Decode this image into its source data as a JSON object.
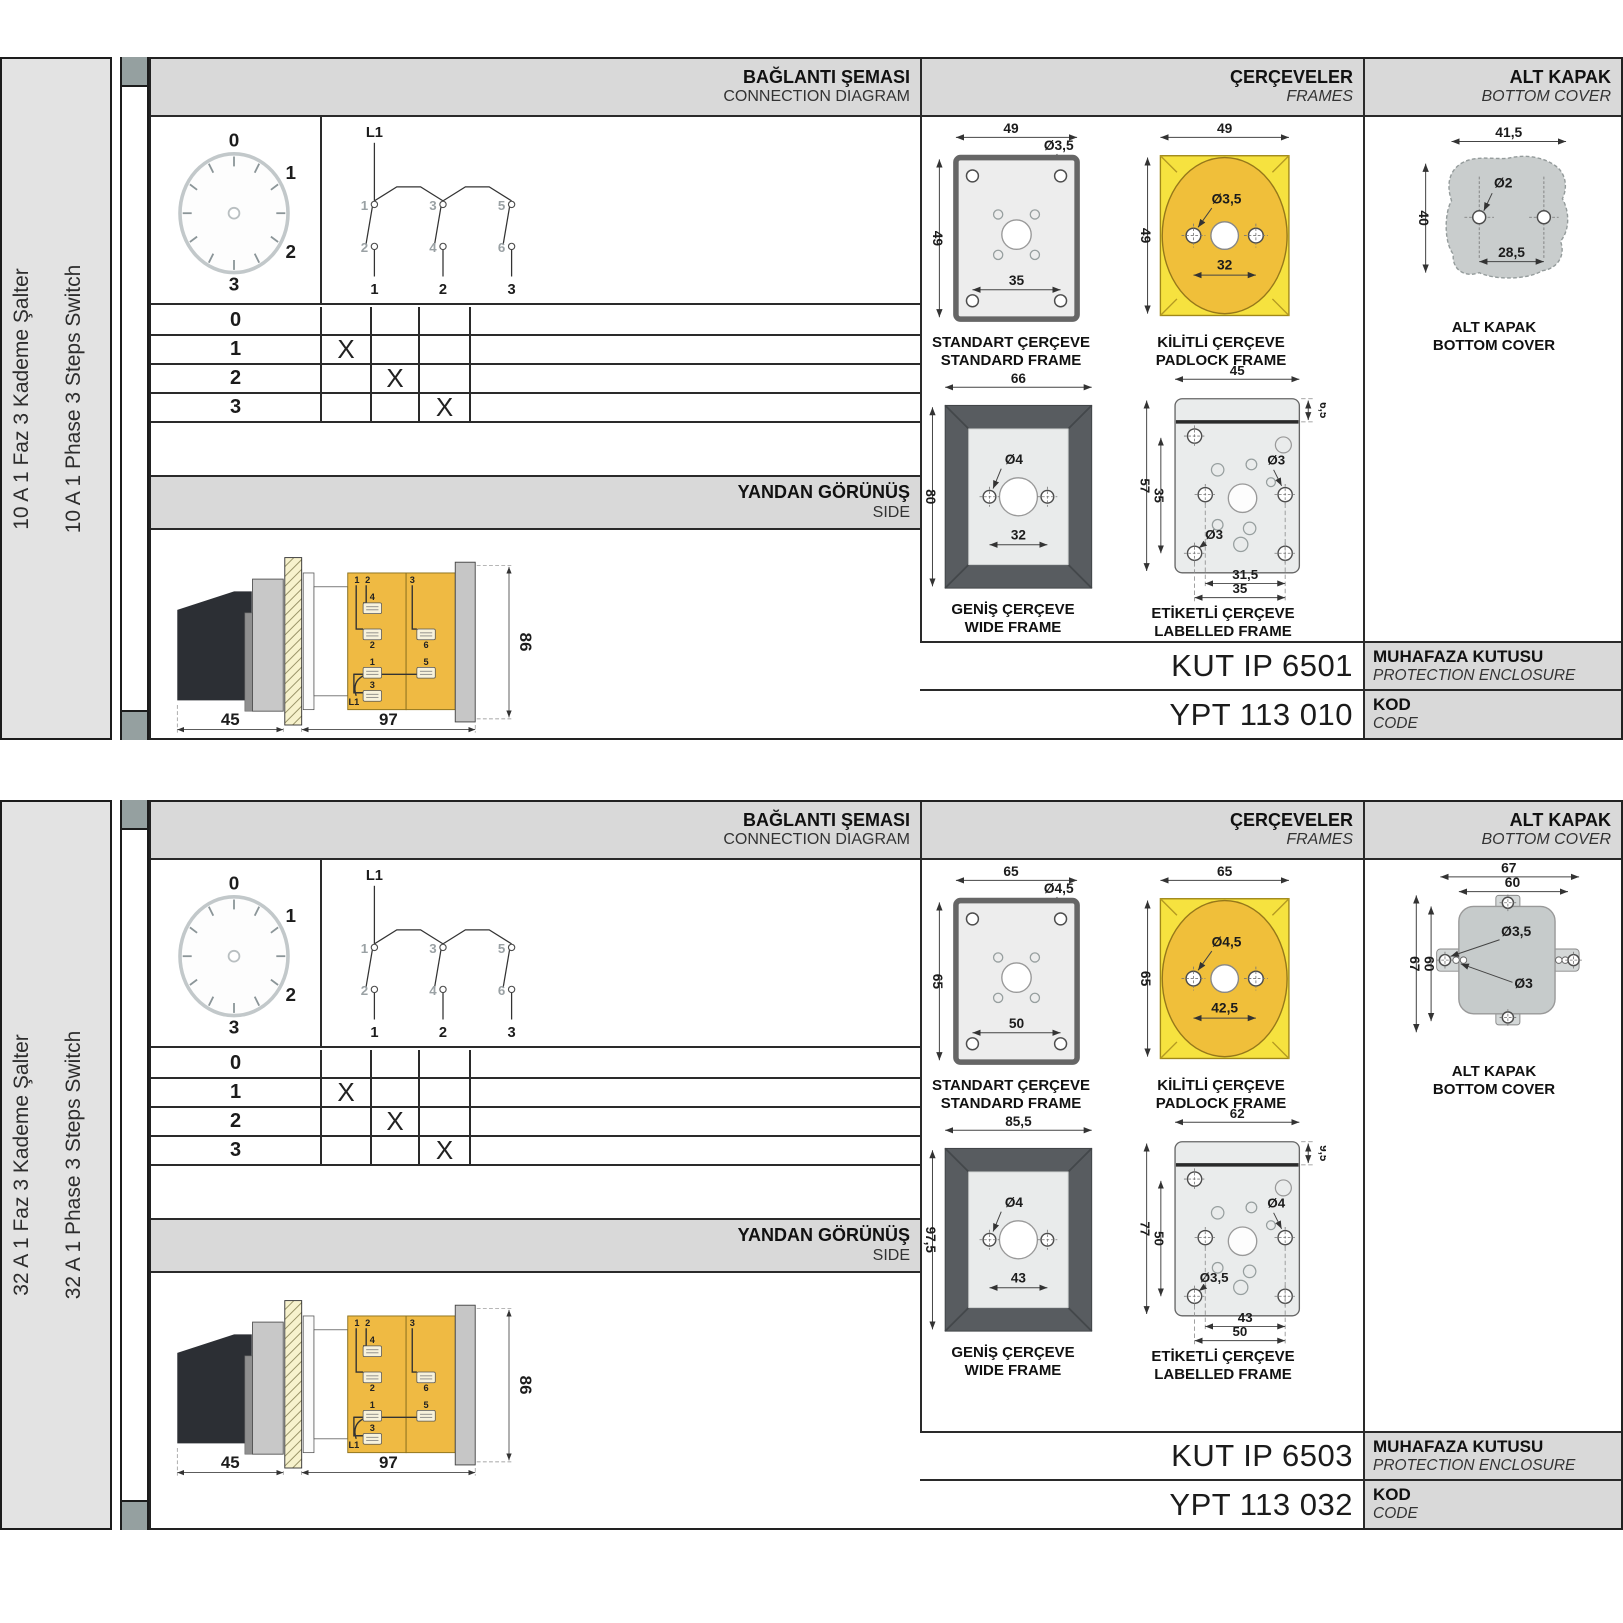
{
  "colors": {
    "header_grey": "#d9d9d9",
    "padlock_yellow": "#f6e23f",
    "padlock_gold": "#f0bf3a",
    "body_amber": "#efba43",
    "wide_frame_dark": "#585c60",
    "cover_grey": "#c9cdcd",
    "rail_grey": "#e3e3e3"
  },
  "sections": [
    {
      "sidebar": {
        "label_tr": "10 A 1 Faz 3 Kademe Şalter",
        "label_en": "10 A 1 Phase 3 Steps Switch"
      },
      "headers": {
        "connection_tr": "BAĞLANTI ŞEMASI",
        "connection_en": "CONNECTION DIAGRAM",
        "frames_tr": "ÇERÇEVELER",
        "frames_en": "FRAMES",
        "cover_tr": "ALT KAPAK",
        "cover_en": "BOTTOM COVER",
        "side_tr": "YANDAN GÖRÜNÜŞ",
        "side_en": "SIDE"
      },
      "dial": {
        "labels": [
          "0",
          "1",
          "2",
          "3"
        ]
      },
      "schematic": {
        "feed": "L1",
        "top_terms": [
          "1",
          "3",
          "5"
        ],
        "bottom_terms": [
          "2",
          "4",
          "6"
        ],
        "poles": [
          "1",
          "2",
          "3"
        ]
      },
      "step_table": {
        "rows": [
          {
            "step": "0",
            "marks": [
              "",
              "",
              ""
            ]
          },
          {
            "step": "1",
            "marks": [
              "X",
              "",
              ""
            ]
          },
          {
            "step": "2",
            "marks": [
              "",
              "X",
              ""
            ]
          },
          {
            "step": "3",
            "marks": [
              "",
              "",
              "X"
            ]
          }
        ]
      },
      "side_view": {
        "dim_width_handle": "45",
        "dim_width_body": "97",
        "dim_height": "86",
        "labels": {
          "top_left_a": "1",
          "top_left_b": "2",
          "top_right": "3",
          "t4": "4",
          "t2": "2",
          "t6": "6",
          "t1": "1",
          "t5": "5",
          "t3": "3",
          "feed": "L1"
        }
      },
      "standard_frame": {
        "title_tr": "STANDART ÇERÇEVE",
        "title_en": "STANDARD FRAME",
        "dim_width": "49",
        "dim_height": "49",
        "hole_dia": "Ø3,5",
        "dim_holes": "35"
      },
      "padlock_frame": {
        "title_tr": "KİLİTLİ ÇERÇEVE",
        "title_en": "PADLOCK FRAME",
        "dim_width": "49",
        "dim_height": "49",
        "hole_dia": "Ø3,5",
        "dim_holes": "32"
      },
      "wide_frame": {
        "title_tr": "GENİŞ ÇERÇEVE",
        "title_en": "WIDE FRAME",
        "dim_width": "66",
        "dim_height": "80",
        "hole_dia": "Ø4",
        "dim_holes": "32"
      },
      "labelled_frame": {
        "title_tr": "ETİKETLİ ÇERÇEVE",
        "title_en": "LABELLED FRAME",
        "dim_width": "45",
        "dim_strip": "6,5",
        "dim_height_outer": "57",
        "dim_height_inner": "35",
        "hole_dia_right": "Ø3",
        "hole_dia_left": "Ø3",
        "dim_holes_inner": "31,5",
        "dim_holes_outer": "35"
      },
      "bottom_cover": {
        "title_tr": "ALT KAPAK",
        "title_en": "BOTTOM COVER",
        "dim_width": "41,5",
        "dim_height": "40",
        "hole_dia": "Ø2",
        "dim_holes": "28,5"
      },
      "codes": {
        "enclosure_code": "KUT IP 6501",
        "enclosure_label_tr": "MUHAFAZA KUTUSU",
        "enclosure_label_en": "PROTECTION ENCLOSURE",
        "product_code": "YPT 113 010",
        "code_label_tr": "KOD",
        "code_label_en": "CODE"
      }
    },
    {
      "sidebar": {
        "label_tr": "32 A 1 Faz 3 Kademe Şalter",
        "label_en": "32 A 1 Phase 3 Steps Switch"
      },
      "headers": {
        "connection_tr": "BAĞLANTI ŞEMASI",
        "connection_en": "CONNECTION DIAGRAM",
        "frames_tr": "ÇERÇEVELER",
        "frames_en": "FRAMES",
        "cover_tr": "ALT KAPAK",
        "cover_en": "BOTTOM COVER",
        "side_tr": "YANDAN GÖRÜNÜŞ",
        "side_en": "SIDE"
      },
      "dial": {
        "labels": [
          "0",
          "1",
          "2",
          "3"
        ]
      },
      "schematic": {
        "feed": "L1",
        "top_terms": [
          "1",
          "3",
          "5"
        ],
        "bottom_terms": [
          "2",
          "4",
          "6"
        ],
        "poles": [
          "1",
          "2",
          "3"
        ]
      },
      "step_table": {
        "rows": [
          {
            "step": "0",
            "marks": [
              "",
              "",
              ""
            ]
          },
          {
            "step": "1",
            "marks": [
              "X",
              "",
              ""
            ]
          },
          {
            "step": "2",
            "marks": [
              "",
              "X",
              ""
            ]
          },
          {
            "step": "3",
            "marks": [
              "",
              "",
              "X"
            ]
          }
        ]
      },
      "side_view": {
        "dim_width_handle": "45",
        "dim_width_body": "97",
        "dim_height": "86",
        "labels": {
          "top_left_a": "1",
          "top_left_b": "2",
          "top_right": "3",
          "t4": "4",
          "t2": "2",
          "t6": "6",
          "t1": "1",
          "t5": "5",
          "t3": "3",
          "feed": "L1"
        }
      },
      "standard_frame": {
        "title_tr": "STANDART ÇERÇEVE",
        "title_en": "STANDARD FRAME",
        "dim_width": "65",
        "dim_height": "65",
        "hole_dia": "Ø4,5",
        "dim_holes": "50"
      },
      "padlock_frame": {
        "title_tr": "KİLİTLİ ÇERÇEVE",
        "title_en": "PADLOCK FRAME",
        "dim_width": "65",
        "dim_height": "65",
        "hole_dia": "Ø4,5",
        "dim_holes": "42,5"
      },
      "wide_frame": {
        "title_tr": "GENİŞ ÇERÇEVE",
        "title_en": "WIDE FRAME",
        "dim_width": "85,5",
        "dim_height": "97,5",
        "hole_dia": "Ø4",
        "dim_holes": "43"
      },
      "labelled_frame": {
        "title_tr": "ETİKETLİ ÇERÇEVE",
        "title_en": "LABELLED FRAME",
        "dim_width": "62",
        "dim_strip": "9,5",
        "dim_height_outer": "77",
        "dim_height_inner": "50",
        "hole_dia_right": "Ø4",
        "hole_dia_left": "Ø3,5",
        "dim_holes_inner": "43",
        "dim_holes_outer": "50"
      },
      "bottom_cover": {
        "title_tr": "ALT KAPAK",
        "title_en": "BOTTOM COVER",
        "dim_width_outer": "67",
        "dim_width_inner": "60",
        "dim_height_outer": "67",
        "dim_height_inner": "60",
        "hole_dia_tab": "Ø3,5",
        "hole_dia_small": "Ø3"
      },
      "codes": {
        "enclosure_code": "KUT IP 6503",
        "enclosure_label_tr": "MUHAFAZA KUTUSU",
        "enclosure_label_en": "PROTECTION ENCLOSURE",
        "product_code": "YPT 113 032",
        "code_label_tr": "KOD",
        "code_label_en": "CODE"
      }
    }
  ]
}
